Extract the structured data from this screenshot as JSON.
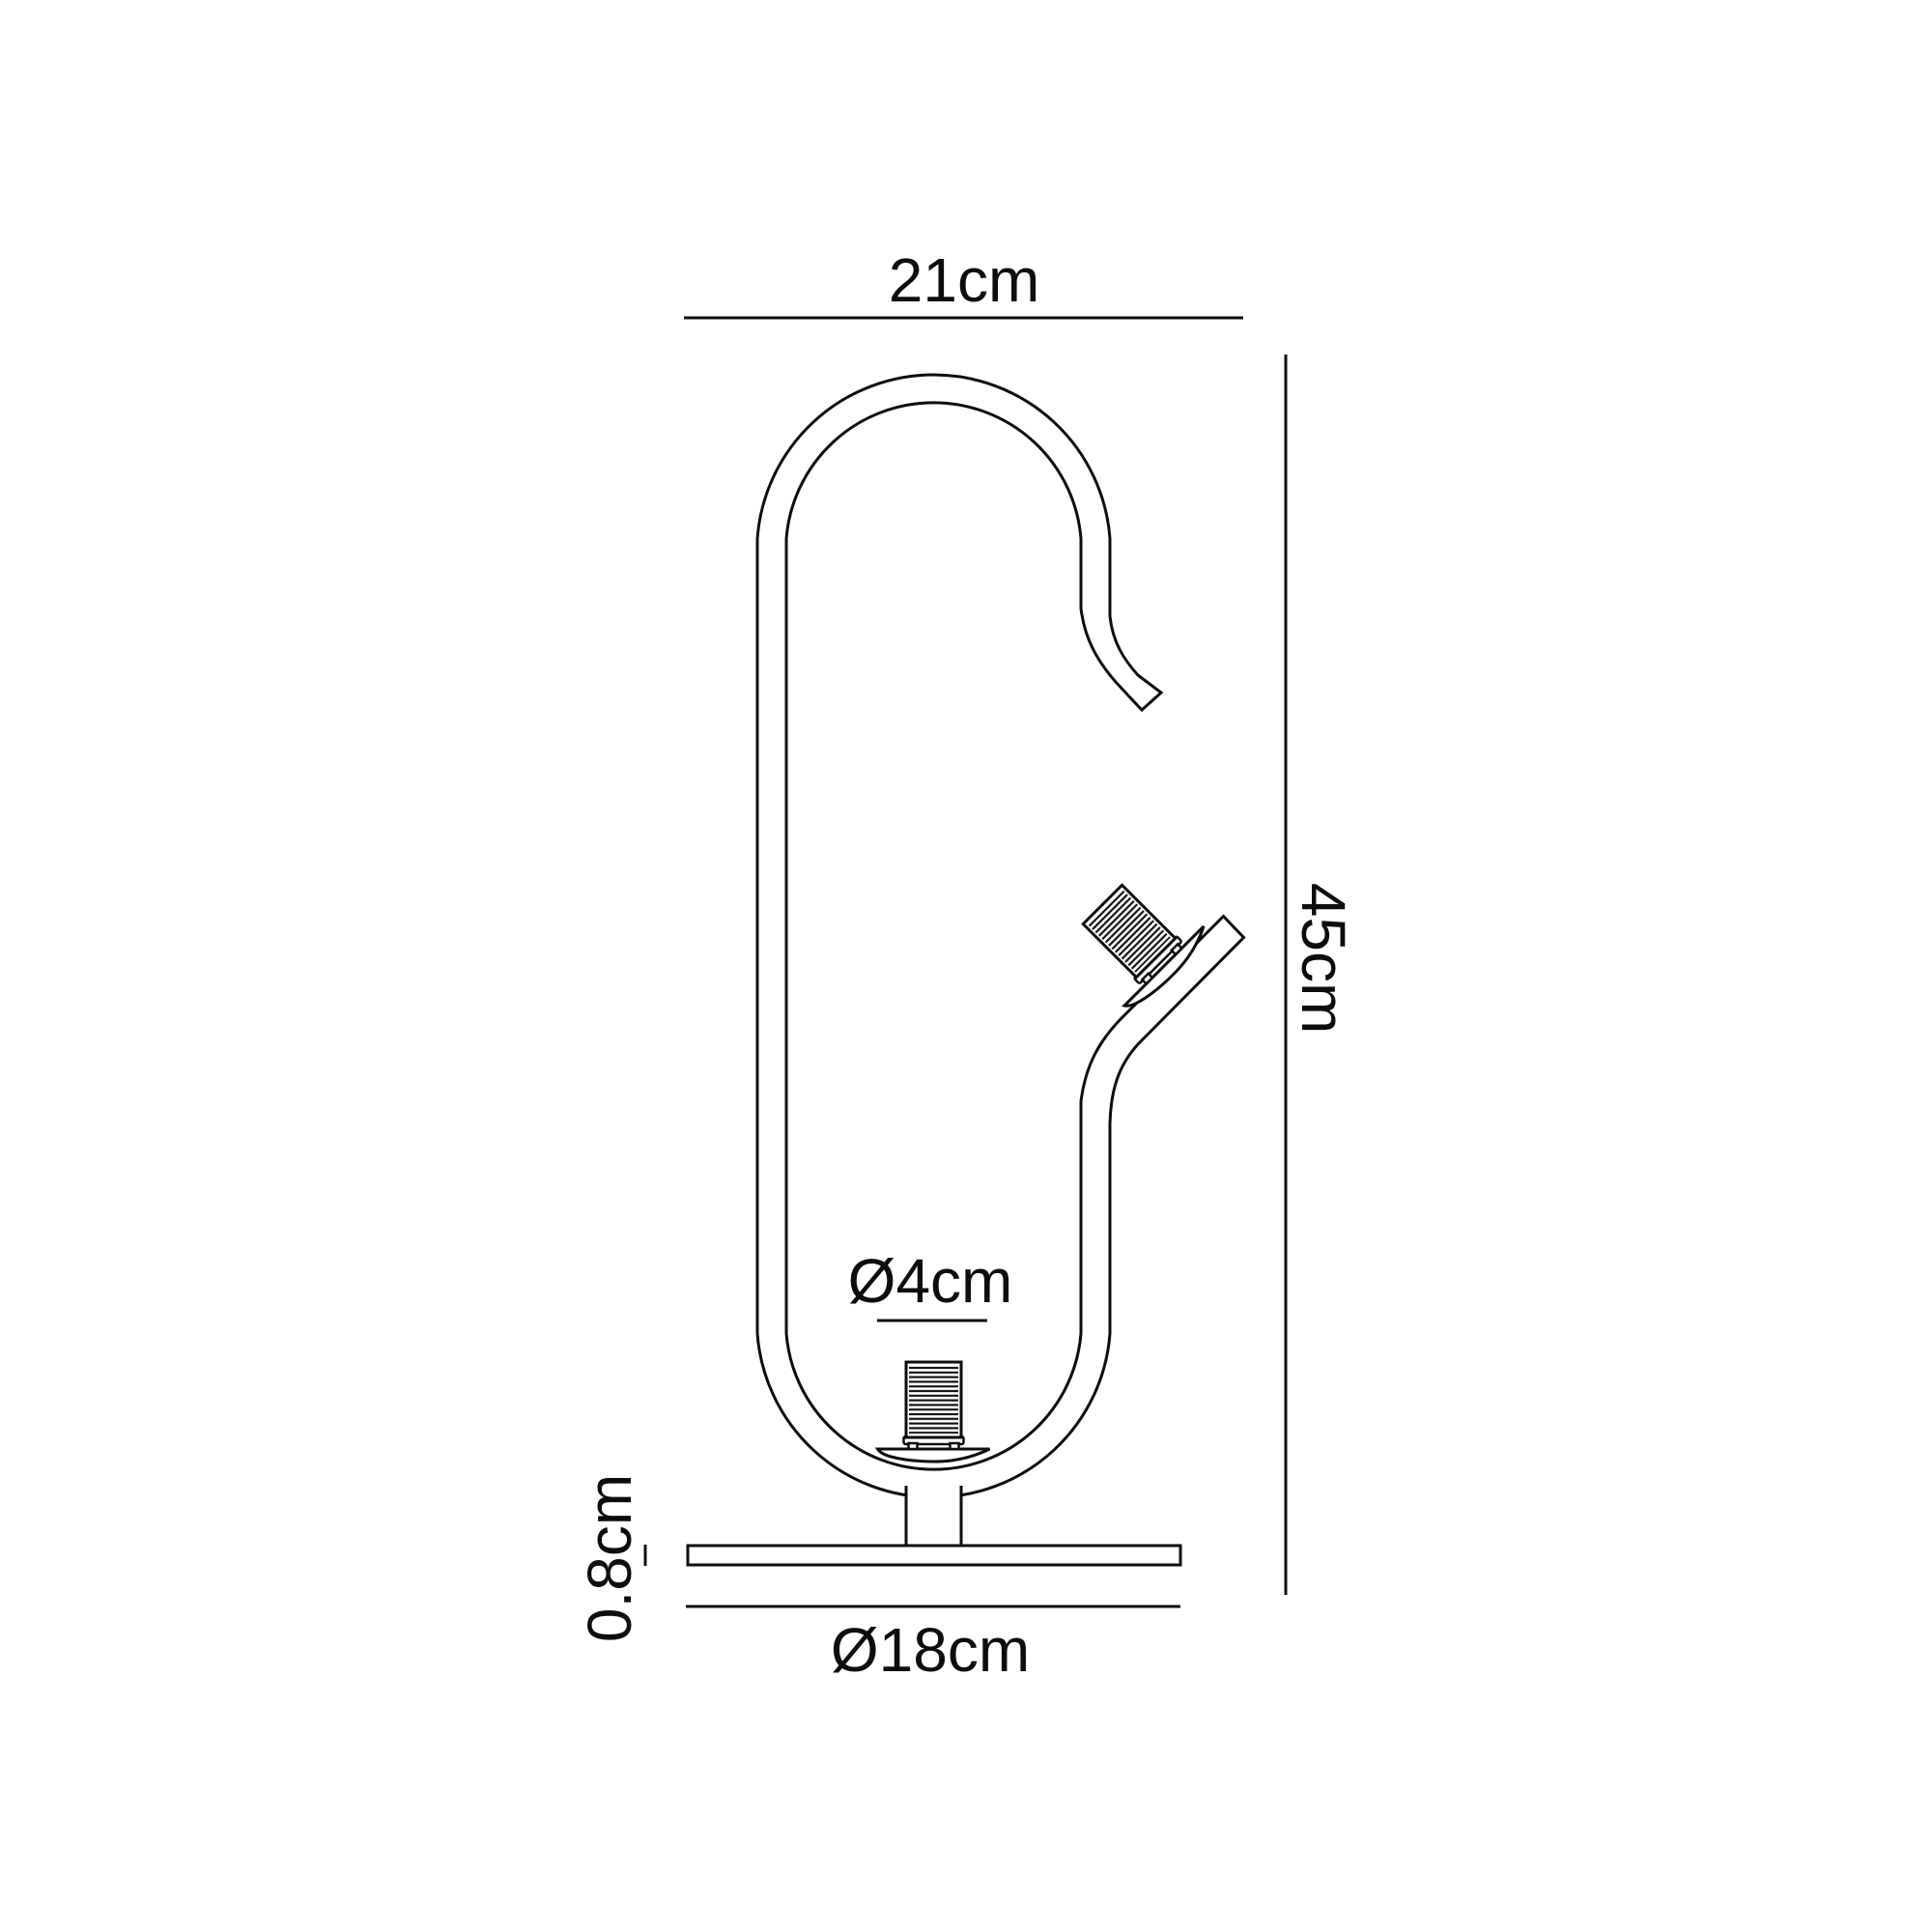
{
  "colors": {
    "ink": "#0d0d0d",
    "paper": "#ffffff"
  },
  "dimensions": {
    "top_width": "21cm",
    "height": "45cm",
    "socket_diameter": "Ø4cm",
    "base_thickness": "0.8cm",
    "base_diameter": "Ø18cm"
  }
}
